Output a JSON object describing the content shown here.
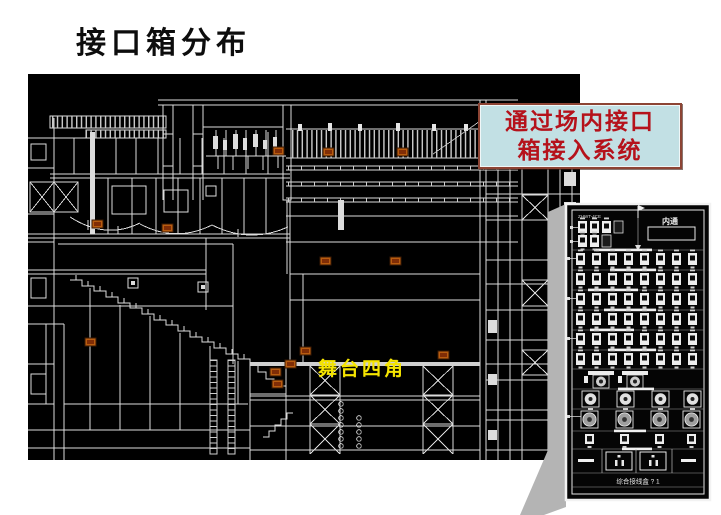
{
  "slide": {
    "title": "接口箱分布",
    "background": "#ffffff"
  },
  "drawing": {
    "background": "#000000",
    "line_color": "#dcdcdc",
    "stage_label": "舞台四角",
    "stage_label_color": "#f5e400",
    "marker_color": "#b85c10"
  },
  "callout": {
    "line1": "通过场内接口",
    "line2": "箱接入系统",
    "text_color": "#b5121b",
    "background": "#c2e0e4",
    "border_color": "#8d4434"
  },
  "panel": {
    "code_label": "ZHWT-4CE",
    "intercom_label": "内通",
    "bottom_label": "综合接线盒 ? 1",
    "shadow_color": "#b4b4b4"
  }
}
